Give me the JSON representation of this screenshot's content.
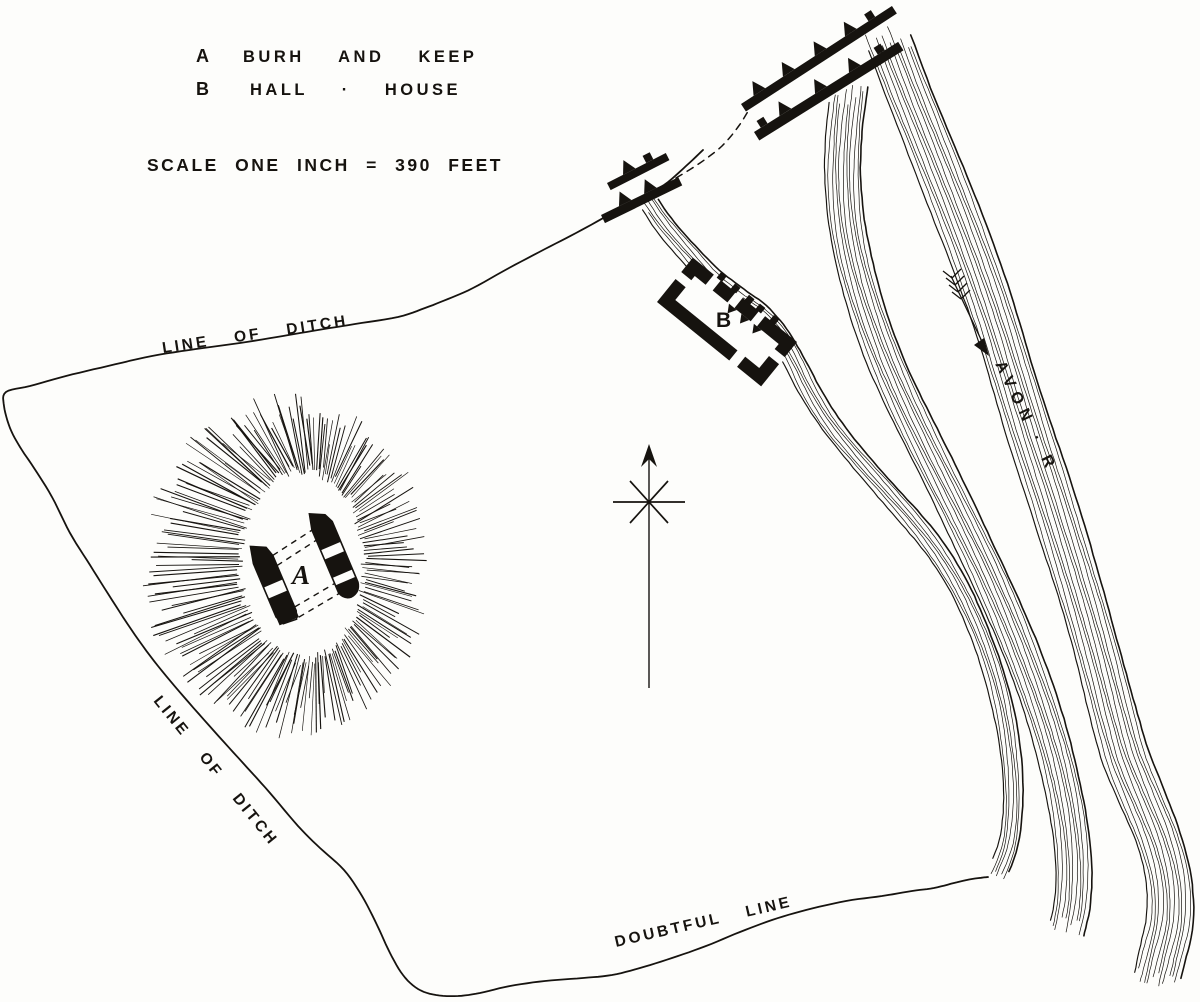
{
  "figure": {
    "background": "#fdfdfb",
    "ink": "#16130f",
    "description": "Engraved plan of an earthwork enclosure beside the River Avon"
  },
  "legend": {
    "items": [
      {
        "key": "A",
        "label": "BURH AND KEEP"
      },
      {
        "key": "B",
        "label": "HALL · HOUSE"
      }
    ],
    "scale_note": "SCALE ONE INCH = 390 FEET"
  },
  "map_labels": {
    "ditch_top": "LINE OF DITCH",
    "ditch_left": "LINE OF DITCH",
    "doubtful": "DOUBTFUL LINE",
    "river": "AVON · R",
    "keep_marker": "A",
    "hall_marker": "B"
  }
}
